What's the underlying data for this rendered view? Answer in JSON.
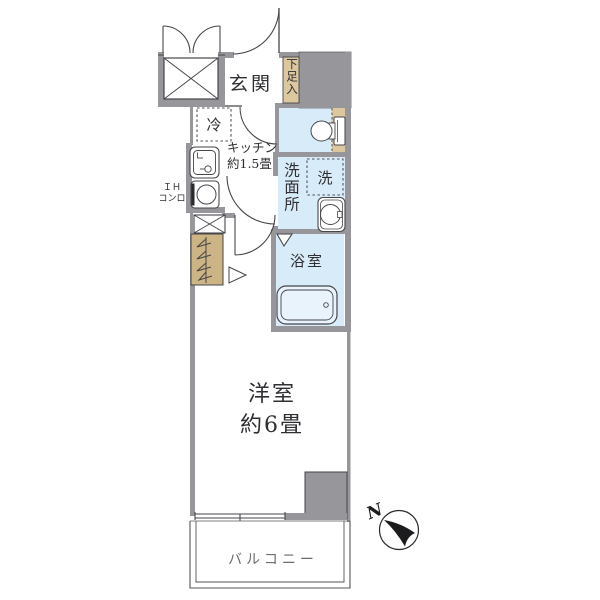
{
  "floor_plan": {
    "labels": {
      "genkan": "玄関",
      "shoe_cabinet": "下足入",
      "refrigerator": "冷",
      "kitchen_name": "キッチン",
      "kitchen_size": "約1.5畳",
      "stove_line1": "ＩＨ",
      "stove_line2": "コンロ",
      "washroom": "洗面所",
      "washing_machine": "洗",
      "bathroom": "浴室",
      "main_room_name": "洋室",
      "main_room_size": "約6畳",
      "balcony": "バルコニー"
    },
    "compass": {
      "north": "N"
    },
    "colors": {
      "wall": "#97979b",
      "wet_area_floor": "#d8ebf8",
      "cabinet_tan": "#dcc79e",
      "closet_tan": "#cdb484",
      "line": "#46464a",
      "text": "#2f2f33",
      "balcony_text": "#6b6b70",
      "bathtub_fill": "#e9f3fb"
    }
  }
}
